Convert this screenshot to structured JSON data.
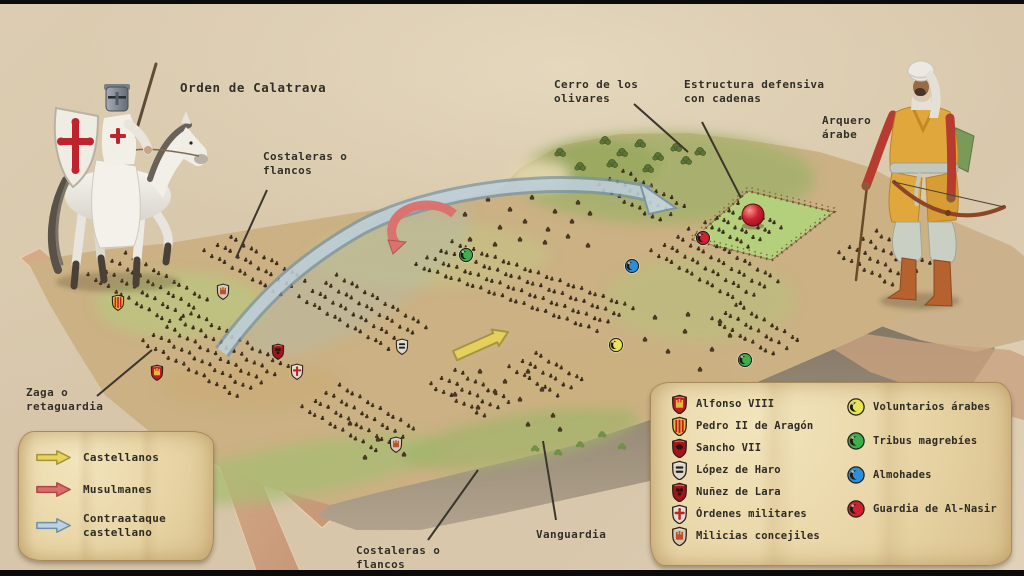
{
  "annotations": [
    {
      "id": "orden-de-calatrava",
      "text": "Orden de Calatrava",
      "x": 180,
      "y": 80,
      "big": true
    },
    {
      "id": "costaleras-flancos-top",
      "text": "Costaleras o\nflancos",
      "x": 263,
      "y": 150,
      "line": [
        267,
        190,
        236,
        258
      ]
    },
    {
      "id": "cerro-de-los-olivares",
      "text": "Cerro de los\nolivares",
      "x": 554,
      "y": 78,
      "line": [
        634,
        104,
        688,
        152
      ]
    },
    {
      "id": "estructura-defensiva",
      "text": "Estructura defensiva\ncon cadenas",
      "x": 684,
      "y": 78,
      "line": [
        702,
        122,
        741,
        198
      ]
    },
    {
      "id": "arquero-arabe",
      "text": "Arquero\nárabe",
      "x": 822,
      "y": 114
    },
    {
      "id": "zaga-retaguardia",
      "text": "Zaga o\nretaguardia",
      "x": 26,
      "y": 386,
      "line": [
        97,
        396,
        152,
        350
      ]
    },
    {
      "id": "vanguardia",
      "text": "Vanguardia",
      "x": 536,
      "y": 528,
      "line": [
        556,
        520,
        543,
        441
      ]
    },
    {
      "id": "costaleras-flancos-bottom",
      "text": "Costaleras o\nflancos",
      "x": 356,
      "y": 544,
      "line": [
        428,
        540,
        478,
        470
      ]
    }
  ],
  "legend_arrows": {
    "items": [
      {
        "id": "castellanos",
        "label": "Castellanos",
        "fill": "#e8d45a",
        "stroke": "#a3923a"
      },
      {
        "id": "musulmanes",
        "label": "Musulmanes",
        "fill": "#dd6b6b",
        "stroke": "#a84848"
      },
      {
        "id": "contraataque",
        "label": "Contraataque\ncastellano",
        "fill": "#bdd2de",
        "stroke": "#6f8fa6"
      }
    ]
  },
  "legend_units": {
    "commanders": [
      {
        "id": "alfonso-viii",
        "label": "Alfonso VIII",
        "shield": "castile"
      },
      {
        "id": "pedro-ii-aragon",
        "label": "Pedro II de Aragón",
        "shield": "aragon"
      },
      {
        "id": "sancho-vii",
        "label": "Sancho VII",
        "shield": "navarra"
      },
      {
        "id": "lopez-de-haro",
        "label": "López de Haro",
        "shield": "haro"
      },
      {
        "id": "nunez-de-lara",
        "label": "Nuñez de Lara",
        "shield": "lara"
      },
      {
        "id": "ordenes-militares",
        "label": "Órdenes militares",
        "shield": "ordenes"
      },
      {
        "id": "milicias-concejiles",
        "label": "Milicias concejiles",
        "shield": "milicias"
      }
    ],
    "muslim_units": [
      {
        "id": "voluntarios-arabes",
        "label": "Voluntarios árabes",
        "color": "#e9e455"
      },
      {
        "id": "tribus-magrebies",
        "label": "Tribus magrebíes",
        "color": "#3fae4c"
      },
      {
        "id": "almohades",
        "label": "Almohades",
        "color": "#2e8fd8"
      },
      {
        "id": "guardia-al-nasir",
        "label": "Guardia de Al-Nasir",
        "color": "#d0212e"
      }
    ]
  },
  "shield_styles": {
    "castile": {
      "field": "#c11a22",
      "emblem": "#e9b93c"
    },
    "aragon": {
      "field": "#e9b93c",
      "emblem": "#c11a22"
    },
    "navarra": {
      "field": "#a8131b",
      "emblem": "#26170f"
    },
    "haro": {
      "field": "#dcd9cf",
      "emblem": "#26211c"
    },
    "lara": {
      "field": "#a8131b",
      "emblem": "#26170f"
    },
    "ordenes": {
      "field": "#e2ddd2",
      "emblem": "#c02323"
    },
    "milicias": {
      "field": "#cfc9ba",
      "emblem": "#bf4f28"
    }
  },
  "map": {
    "soldier_colors": [
      "#44331f",
      "#392c1b"
    ],
    "markers": [
      {
        "unit": "tribus-magrebies",
        "color": "#3fae4c",
        "x": 466,
        "y": 255
      },
      {
        "unit": "tribus-magrebies",
        "color": "#3fae4c",
        "x": 745,
        "y": 360
      },
      {
        "unit": "almohades",
        "color": "#2e8fd8",
        "x": 632,
        "y": 266
      },
      {
        "unit": "voluntarios-arabes",
        "color": "#e9e455",
        "x": 616,
        "y": 345
      },
      {
        "unit": "guardia-al-nasir",
        "color": "#d0212e",
        "x": 703,
        "y": 238
      }
    ],
    "sphere": {
      "x": 753,
      "y": 215,
      "r": 11,
      "unit": "guardia-al-nasir"
    },
    "shields": [
      {
        "style": "aragon",
        "x": 118,
        "y": 303
      },
      {
        "style": "castile",
        "x": 157,
        "y": 373
      },
      {
        "style": "milicias",
        "x": 223,
        "y": 292
      },
      {
        "style": "lara",
        "x": 278,
        "y": 352
      },
      {
        "style": "ordenes",
        "x": 297,
        "y": 372
      },
      {
        "style": "haro",
        "x": 402,
        "y": 347
      },
      {
        "style": "milicias",
        "x": 396,
        "y": 445
      }
    ],
    "formations": [
      {
        "x": 205,
        "y": 252,
        "rows": 3,
        "cols": 12
      },
      {
        "x": 88,
        "y": 276,
        "rows": 4,
        "cols": 13
      },
      {
        "x": 142,
        "y": 342,
        "rows": 5,
        "cols": 15
      },
      {
        "x": 300,
        "y": 298,
        "rows": 4,
        "cols": 14
      },
      {
        "x": 302,
        "y": 408,
        "rows": 4,
        "cols": 12
      },
      {
        "x": 430,
        "y": 385,
        "rows": 3,
        "cols": 9
      },
      {
        "x": 510,
        "y": 368,
        "rows": 3,
        "cols": 8
      },
      {
        "x": 452,
        "y": 243,
        "rows": 4,
        "cols": 26,
        "sx": 7.2,
        "sy": 2.6,
        "rx": -12,
        "ry": 7.6
      },
      {
        "x": 598,
        "y": 186,
        "rows": 3,
        "cols": 10
      },
      {
        "x": 652,
        "y": 252,
        "rows": 4,
        "cols": 14
      },
      {
        "x": 712,
        "y": 320,
        "rows": 3,
        "cols": 10
      },
      {
        "x": 838,
        "y": 254,
        "rows": 4,
        "cols": 9
      },
      {
        "x": 706,
        "y": 224,
        "rows": 4,
        "cols": 8,
        "sx": 6,
        "sy": 3.2,
        "rx": 11,
        "ry": -6.4
      }
    ],
    "clusters": [
      [
        465,
        215
      ],
      [
        488,
        200
      ],
      [
        510,
        210
      ],
      [
        532,
        198
      ],
      [
        555,
        212
      ],
      [
        578,
        203
      ],
      [
        500,
        228
      ],
      [
        525,
        222
      ],
      [
        548,
        230
      ],
      [
        572,
        222
      ],
      [
        470,
        240
      ],
      [
        495,
        245
      ],
      [
        520,
        240
      ],
      [
        545,
        243
      ],
      [
        568,
        237
      ],
      [
        590,
        214
      ],
      [
        588,
        246
      ],
      [
        655,
        318
      ],
      [
        685,
        332
      ],
      [
        712,
        350
      ],
      [
        668,
        352
      ],
      [
        700,
        370
      ],
      [
        730,
        336
      ],
      [
        645,
        340
      ],
      [
        688,
        315
      ],
      [
        720,
        322
      ],
      [
        480,
        372
      ],
      [
        505,
        382
      ],
      [
        528,
        372
      ],
      [
        495,
        392
      ],
      [
        520,
        400
      ],
      [
        542,
        390
      ],
      [
        553,
        416
      ],
      [
        528,
        425
      ],
      [
        478,
        408
      ],
      [
        455,
        395
      ],
      [
        560,
        430
      ],
      [
        350,
        424
      ],
      [
        378,
        440
      ],
      [
        404,
        455
      ],
      [
        365,
        458
      ]
    ],
    "trees": [
      [
        605,
        140
      ],
      [
        622,
        152
      ],
      [
        640,
        143
      ],
      [
        658,
        156
      ],
      [
        676,
        147
      ],
      [
        612,
        163
      ],
      [
        648,
        168
      ],
      [
        686,
        160
      ],
      [
        700,
        151
      ],
      [
        560,
        152
      ],
      [
        580,
        166
      ]
    ],
    "bushes": [
      [
        535,
        448
      ],
      [
        558,
        452
      ],
      [
        580,
        444
      ],
      [
        602,
        434
      ],
      [
        622,
        446
      ]
    ]
  }
}
